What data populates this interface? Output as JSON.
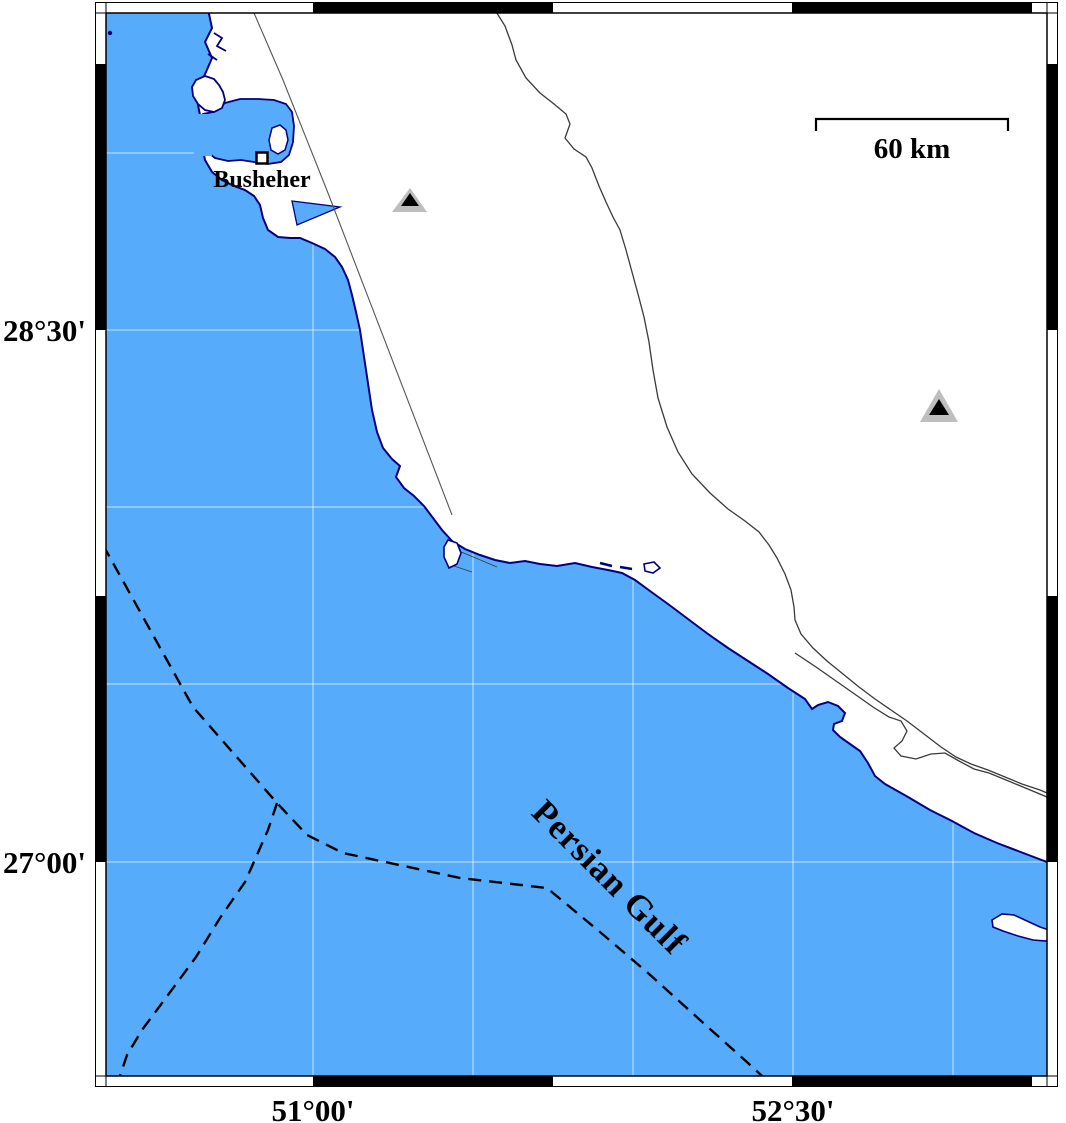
{
  "map": {
    "colors": {
      "sea": "#56ACFA",
      "land": "#ffffff",
      "coast": "#000080",
      "river": "#3a3a3a",
      "fault": "#555555",
      "grid": "rgba(255,255,255,0.55)",
      "triangle": "#BEBEBE",
      "frame_black": "#000000"
    },
    "labels": {
      "city": "Busheher",
      "sea": "Persian Gulf",
      "scalebar": "60 km"
    },
    "axis": {
      "left": [
        {
          "text": "28°30'",
          "x": 86,
          "y": 341
        },
        {
          "text": "27°00'",
          "x": 86,
          "y": 873
        }
      ],
      "bottom": [
        {
          "text": "51°00'",
          "x": 313,
          "y": 1121
        },
        {
          "text": "52°30'",
          "x": 793,
          "y": 1121
        }
      ]
    },
    "sea_label_pos": {
      "transform": "translate(530,814) rotate(45)"
    },
    "city_label_pos": {
      "x": 262,
      "y": 187
    },
    "scalebar": {
      "x1": 816,
      "x2": 1008,
      "y": 119,
      "drop": 12,
      "label_x": 912,
      "label_y": 158
    },
    "frame": {
      "inner": {
        "x": 106,
        "y": 13,
        "w": 941,
        "h": 1063
      },
      "outer": {
        "x": 95.5,
        "y": 2.5,
        "w": 962,
        "h": 1084
      },
      "black": {
        "top": [
          [
            313,
            553
          ],
          [
            792,
            1032
          ]
        ],
        "bottom": [
          [
            313,
            553
          ],
          [
            792,
            1032
          ]
        ],
        "left": [
          [
            64,
            330
          ],
          [
            596,
            862
          ]
        ],
        "right": [
          [
            64,
            330
          ],
          [
            596,
            862
          ]
        ]
      }
    },
    "markers": {
      "city_square": {
        "x": 256.5,
        "y": 152.5,
        "size": 11
      },
      "triangles": [
        {
          "outer": "392,212 427,212 410,188",
          "inner": "401,206 419,206 410,193"
        },
        {
          "outer": "920,422 958,422 939,389",
          "inner": "929,415 949,415 939,399"
        }
      ]
    },
    "geometry": {
      "grid": {
        "v": [
          313,
          473,
          633,
          793,
          953
        ],
        "h": [
          153,
          330,
          507,
          684,
          862
        ]
      },
      "land": "M207,-5 L209,14 L212,28 L205,42 L212,58 L206,72 L200,85 L197,100 L200,115 L203,130 L202,145 L205,160 L212,172 L222,180 L234,186 L245,190 L254,196 L260,205 L263,218 L268,230 L278,237 L290,238 L300,238 L312,243 L325,249 L335,257 L342,267 L348,280 L352,295 L356,312 L360,330 L363,350 L366,370 L369,390 L372,410 L377,432 L383,448 L392,459 L400,466 L396,477 L404,488 L414,496 L424,506 L433,518 L442,530 L452,541 L465,549 L480,555 L495,560 L510,563 L525,561 L540,564 L557,566 L575,563 L592,567 L608,570 L622,573 L635,580 L650,591 L668,604 L688,619 L708,634 L728,648 L748,661 L768,674 L788,688 L805,699 L812,709 L818,705 L828,702 L838,706 L845,713 L842,721 L834,724 L833,730 L840,737 L850,744 L860,751 L868,763 L875,776 L885,784 L908,797 L930,810 L952,821 L974,833 L997,843 L1018,851 L1052,864 L1052,-5 Z",
      "bay": "M213,112 L225,103 L240,99 L258,99 L274,100 L286,104 L292,112 L294,126 L293,142 L289,155 L281,162 L268,164 L254,162 L241,160 L228,161 L215,158 L205,150 L199,136 L197,122 L203,114 Z",
      "bay_mouth_erase": {
        "x": 194,
        "y": 114,
        "w": 18,
        "h": 42
      },
      "wedge": "M292,201 L340,207 L297,225 Z",
      "hook": "M196,80 L205,76 L214,79 L219,85 L223,92 L225,100 L222,108 L214,112 L205,110 L198,104 L193,96 L192,87 Z",
      "bay_island": "M272,128 L280,125 L286,130 L288,140 L285,150 L278,154 L271,150 L269,140 Z",
      "notches": [
        "M214,33 L222,38 L217,46 L226,51",
        "M208,54 L217,60"
      ],
      "rivers": [
        "M495,10 L505,26 L512,45 L516,60 L526,78 L540,93 L554,104 L566,114 L570,124 L565,138 L574,149 L586,157 L592,168 L599,186 L606,202 L613,217 L620,230 L626,250 L632,272 L638,294 L644,317 L649,342 L653,370 L658,398 L667,427 L678,452 L692,474 L710,493 L728,509 L745,521 L759,532 L769,545 L777,558 L785,574 L791,590 L794,607 L795,620 L801,634 L813,648 L827,661 L843,674 L859,687 L875,699 L891,710 L907,721 L924,734 L941,747 L956,757 L971,764 L988,770 L1005,777 L1022,784 L1040,790 L1047,793",
        "M795,653 L816,667 L836,681 L856,695 L873,707 L889,717 L901,721 L907,731 L902,741 L894,748 L901,756 L916,759 L931,754 L945,753 L959,761 L974,769 L989,773 L1006,780 L1023,787 L1047,797"
      ],
      "fault": "M251,6 L283,80 L328,193 L400,380 L452,515",
      "connectors": [
        "M459,551 L497,567",
        "M451,565 L472,572"
      ],
      "islands": [
        "M448,540 L457,543 L461,553 L457,564 L449,568 L444,557 L444,547 Z",
        "M644,564 L654,562 L660,568 L653,573 L645,571 Z",
        "M992,920 L1002,914 L1014,915 L1027,921 L1040,927 L1049,930 L1053,936 L1046,941 L1033,940 L1018,936 L1003,931 L993,927 Z"
      ],
      "islet_marks": [
        "M600,563 l12,3",
        "M620,567 l12,2"
      ],
      "boundaries": [
        "M103,545 L193,707 L277,803 L307,835 L343,853 L460,878 L547,888 L600,932 L648,973 L700,1020 L748,1063 L762,1076",
        "M277,803 L268,830 L245,882 L220,918 L196,957 L168,995 L142,1030 L127,1055 L120,1076"
      ]
    }
  }
}
